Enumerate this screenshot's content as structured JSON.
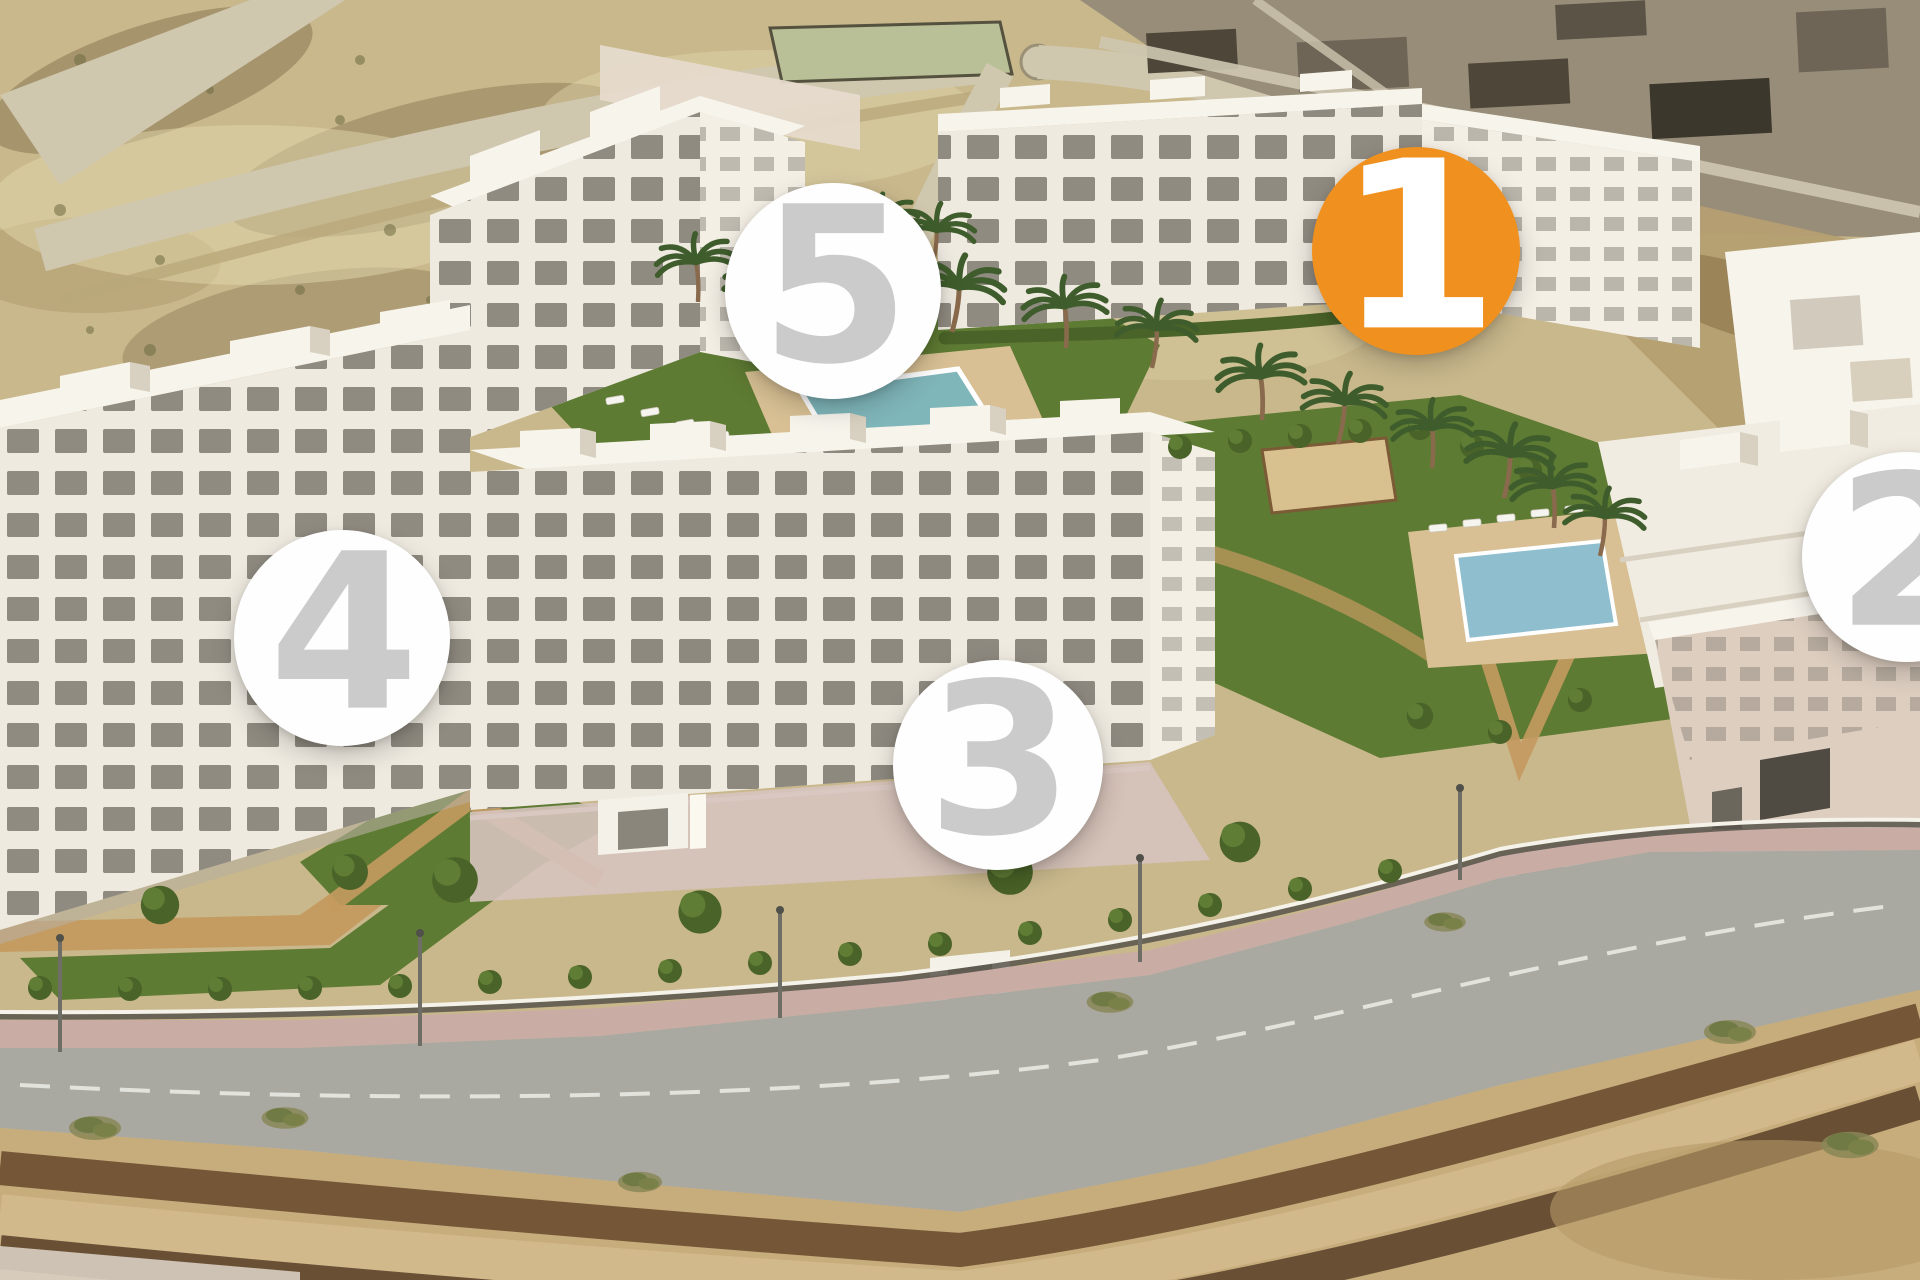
{
  "markers": [
    {
      "label": "1",
      "cx_pct": 73.75,
      "cy_pct": 19.61,
      "diameter_px": 208,
      "circle_color": "#F0901E",
      "number_color": "#FFFFFF",
      "highlighted": true
    },
    {
      "label": "2",
      "cx_pct": 99.32,
      "cy_pct": 43.52,
      "diameter_px": 210,
      "circle_color": "#FEFEFE",
      "number_color": "#CBCBCB",
      "highlighted": false
    },
    {
      "label": "3",
      "cx_pct": 51.98,
      "cy_pct": 59.77,
      "diameter_px": 210,
      "circle_color": "#FEFEFE",
      "number_color": "#CBCBCB",
      "highlighted": false
    },
    {
      "label": "4",
      "cx_pct": 17.81,
      "cy_pct": 49.84,
      "diameter_px": 216,
      "circle_color": "#FEFEFE",
      "number_color": "#CBCBCB",
      "highlighted": false
    },
    {
      "label": "5",
      "cx_pct": 43.39,
      "cy_pct": 22.73,
      "diameter_px": 216,
      "circle_color": "#FEFEFE",
      "number_color": "#CBCBCB",
      "highlighted": false
    }
  ],
  "palette": {
    "marker_active_bg": "#F0901E",
    "marker_active_text": "#FFFFFF",
    "marker_bg": "#FEFEFE",
    "marker_text": "#CBCBCB",
    "sand": "#C9B88C",
    "sand_light": "#E2D7AC",
    "dirt_brown": "#7C6847",
    "scrub": "#6E6C42",
    "road_top": "#CFC7AE",
    "urban_mid": "#978D78",
    "urban_dark": "#4E4739",
    "field_green": "#B9BF96",
    "building_face": "#EFEAE0",
    "building_side": "#F4EFE5",
    "building_roof": "#F7F4EC",
    "building_shade": "#D8D0C0",
    "building_back": "#E6DBCC",
    "window_dark": "#6B675C",
    "lawn": "#5E7B33",
    "hedge": "#4A6328",
    "bush_light": "#5F7D35",
    "tree_light": "#6F8A3C",
    "palm": "#3F5D2C",
    "trunk": "#8A6A4C",
    "path_tan": "#C49A5F",
    "deck_sand": "#D8C094",
    "court": "#D9C08F",
    "court_edge": "#7A5B36",
    "planter_dark": "#4E3A26",
    "pavement": "#C9ADA5",
    "pavement_light": "#D6C3BC",
    "road": "#A9A9A2",
    "road_line": "#EDEDE8",
    "fence_white": "#F5F2EA",
    "fence_dark": "#57534A",
    "embank_light": "#C7AC7C",
    "embank_tan": "#D2B98B",
    "embank_dark": "#6B4E31",
    "embank_ridge": "#5E462E",
    "pale_corner": "#D8CEC2",
    "pool_teal": "#7FB6BA",
    "pool_blue": "#8FBFCF",
    "pool_border": "#FFFFFF",
    "pink_building": "#DDCEC0"
  }
}
